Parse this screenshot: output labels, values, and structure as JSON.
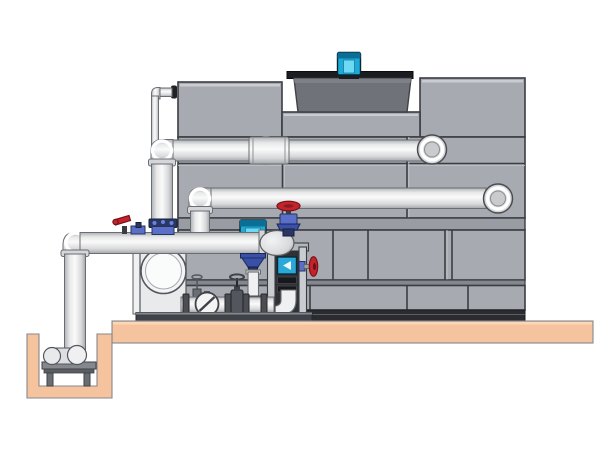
{
  "diagram": {
    "type": "technical-illustration",
    "subject": "Closed-circuit cooling tower installation with fan motor, external piping, vertical inline pump, end-suction pump skid and remote sump pit on a concrete pad",
    "background": "#FFFFFF",
    "visible_text": ""
  },
  "colors": {
    "outline": "#3A3D42",
    "tank_panel": "#A7AAB1",
    "tank_panel_dark": "#999CA3",
    "tank_strip_dark": "#2A2C30",
    "fan_drum": "#6F7278",
    "fan_flange": "#1B1D20",
    "motor_cyan": "#1FA9D6",
    "motor_cyan_light": "#6FD8F2",
    "motor_cyan_dark": "#0B6E94",
    "pipe_light": "#FAFAFA",
    "pipe_mid": "#D8D9DB",
    "pipe_edge": "#AEB1B4",
    "pipe_outline": "#6A6D71",
    "platform_tan": "#F5C39E",
    "platform_tan_light": "#FAD7B8",
    "valve_red": "#C3242A",
    "valve_red_dark": "#7A1118",
    "valve_blue": "#3A4FA8",
    "valve_blue_light": "#5A6FC8",
    "valve_blue_deep": "#2A3764",
    "pump_white": "#EFF0F2",
    "frame_dark": "#2F3135",
    "metal_gray": "#6A6D72"
  },
  "components": {
    "cooling_tower_casing": "paneled cooling tower casing",
    "fan_shroud": "fan discharge shroud on tower roof",
    "fan_motor": "cyan fan drive motor",
    "upper_return_pipe": "upper horizontal return pipe with coupling and elbows",
    "lower_supply_pipe": "second horizontal pipe with end elbows",
    "overflow_line": "thin vertical overflow line with wall grommet",
    "suction_header": "large suction header pipe with down elbow to sump",
    "inline_pump": "vertical inline pump with cyan motor and blue volute",
    "end_suction_pump": "end-suction base pump with round inlet flange",
    "check_valve": "wafer check valve (circle with slash)",
    "gate_valve": "gate valve with handwheel on skid manifold",
    "globe_valve_top": "red handwheel globe valve on header end",
    "side_valve": "red handwheel valve on instrument tower",
    "instrument_tower": "skid frame tower with flow instrument",
    "makeup_valves": "small red lever valve and blue makeup fittings",
    "skid_base": "steel skid base rail",
    "concrete_pad": "concrete equipment pad",
    "sump_pit": "concrete sump pit",
    "sump_pump": "horizontal sump pump on stand"
  }
}
